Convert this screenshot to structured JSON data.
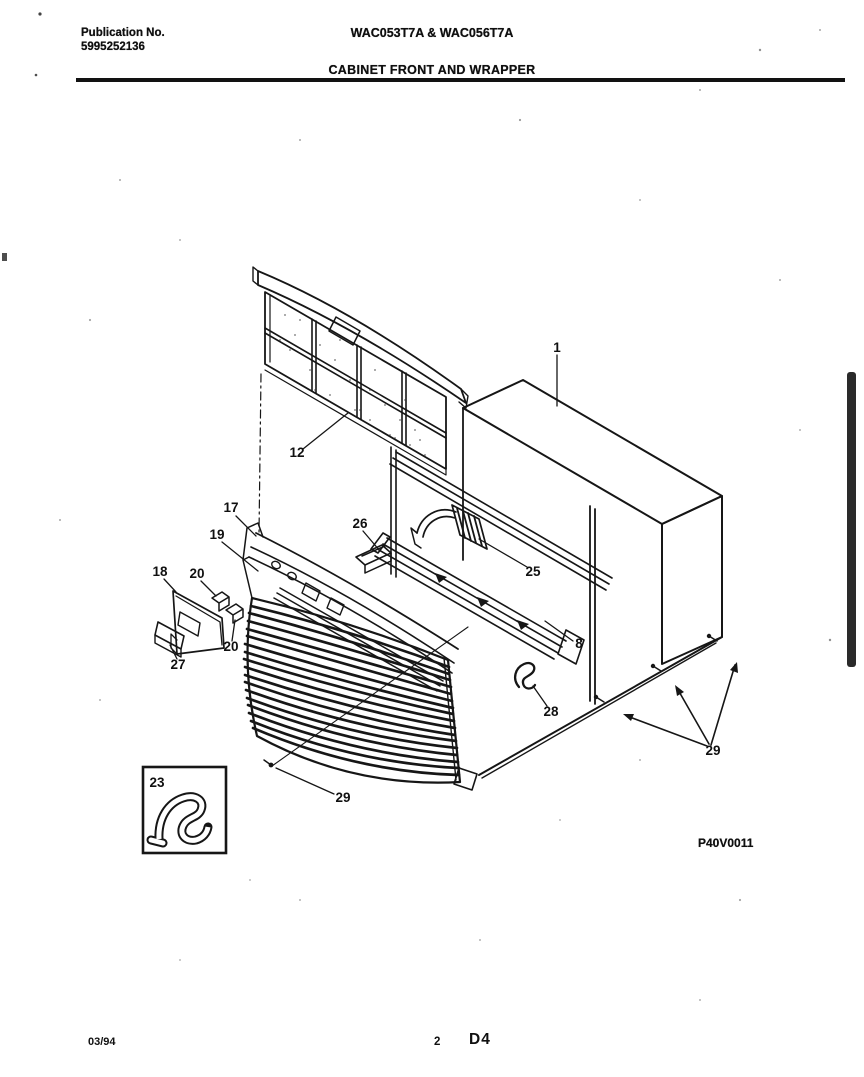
{
  "document": {
    "header": {
      "publication_label": "Publication No.",
      "publication_number": "5995252136",
      "model_numbers": "WAC053T7A & WAC056T7A",
      "section_title": "CABINET FRONT AND WRAPPER"
    },
    "diagram": {
      "figure_code": "P40V0011",
      "callouts": [
        {
          "id": "filter",
          "label": "12"
        },
        {
          "id": "cabinet-wrapper",
          "label": "1"
        },
        {
          "id": "cabinet-front",
          "label": "17"
        },
        {
          "id": "control-panel",
          "label": "19"
        },
        {
          "id": "control-door",
          "label": "18"
        },
        {
          "id": "clip-upper",
          "label": "20"
        },
        {
          "id": "clip-lower",
          "label": "20"
        },
        {
          "id": "bracket",
          "label": "27"
        },
        {
          "id": "channel-bracket",
          "label": "26"
        },
        {
          "id": "air-seal",
          "label": "25"
        },
        {
          "id": "mounting-rail",
          "label": "8"
        },
        {
          "id": "seal-clip",
          "label": "28"
        },
        {
          "id": "screw-front",
          "label": "29"
        },
        {
          "id": "screws-side",
          "label": "29"
        },
        {
          "id": "seal-inset",
          "label": "23"
        }
      ]
    },
    "footer": {
      "date_code": "03/94",
      "page_number": "2",
      "grid_reference": "D4"
    }
  }
}
